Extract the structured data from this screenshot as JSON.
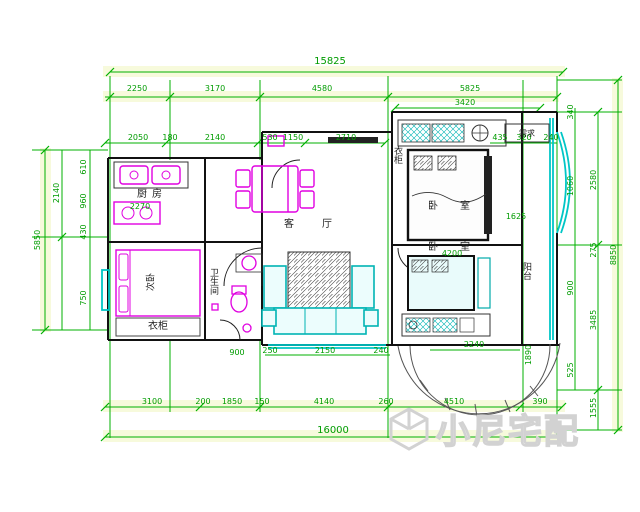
{
  "watermark": {
    "text": "小尼宅配"
  },
  "rooms": {
    "kitchen": "厨房",
    "living": "客厅",
    "bathroom": "卫生间",
    "bedroom_top_right": "卧室",
    "bedroom_bottom_right": "卧室",
    "bedroom_left": "次卧",
    "wardrobe": "衣柜",
    "balcony": "阳台",
    "note_top_right": "需求"
  },
  "dims": {
    "top_total": "15825",
    "top_segments": [
      "2250",
      "3170",
      "4580",
      "5825"
    ],
    "top_sub": "3420",
    "top_small": [
      "2050",
      "180",
      "2140",
      "530",
      "1150",
      "2710"
    ],
    "top_right_small": [
      "435",
      "320",
      "240"
    ],
    "bottom_segments": [
      "3100",
      "200",
      "1850",
      "150",
      "4140",
      "260",
      "4510",
      "390"
    ],
    "bottom_total": "16000",
    "living_small": [
      "250",
      "2150",
      "240"
    ],
    "bath_small": "900",
    "bed_right_width": "4200",
    "bed_right_bottom": "2240",
    "study_small": "1625",
    "balcony_small": "1890",
    "kitchen_small": "2270",
    "left_total": "5850",
    "left_segments": [
      "610",
      "960",
      "430",
      "2140",
      "750"
    ],
    "right_total": "8850",
    "right_segments": [
      "2580",
      "275",
      "3485",
      "1555"
    ],
    "right_small": [
      "340",
      "1060",
      "900",
      "525"
    ]
  }
}
